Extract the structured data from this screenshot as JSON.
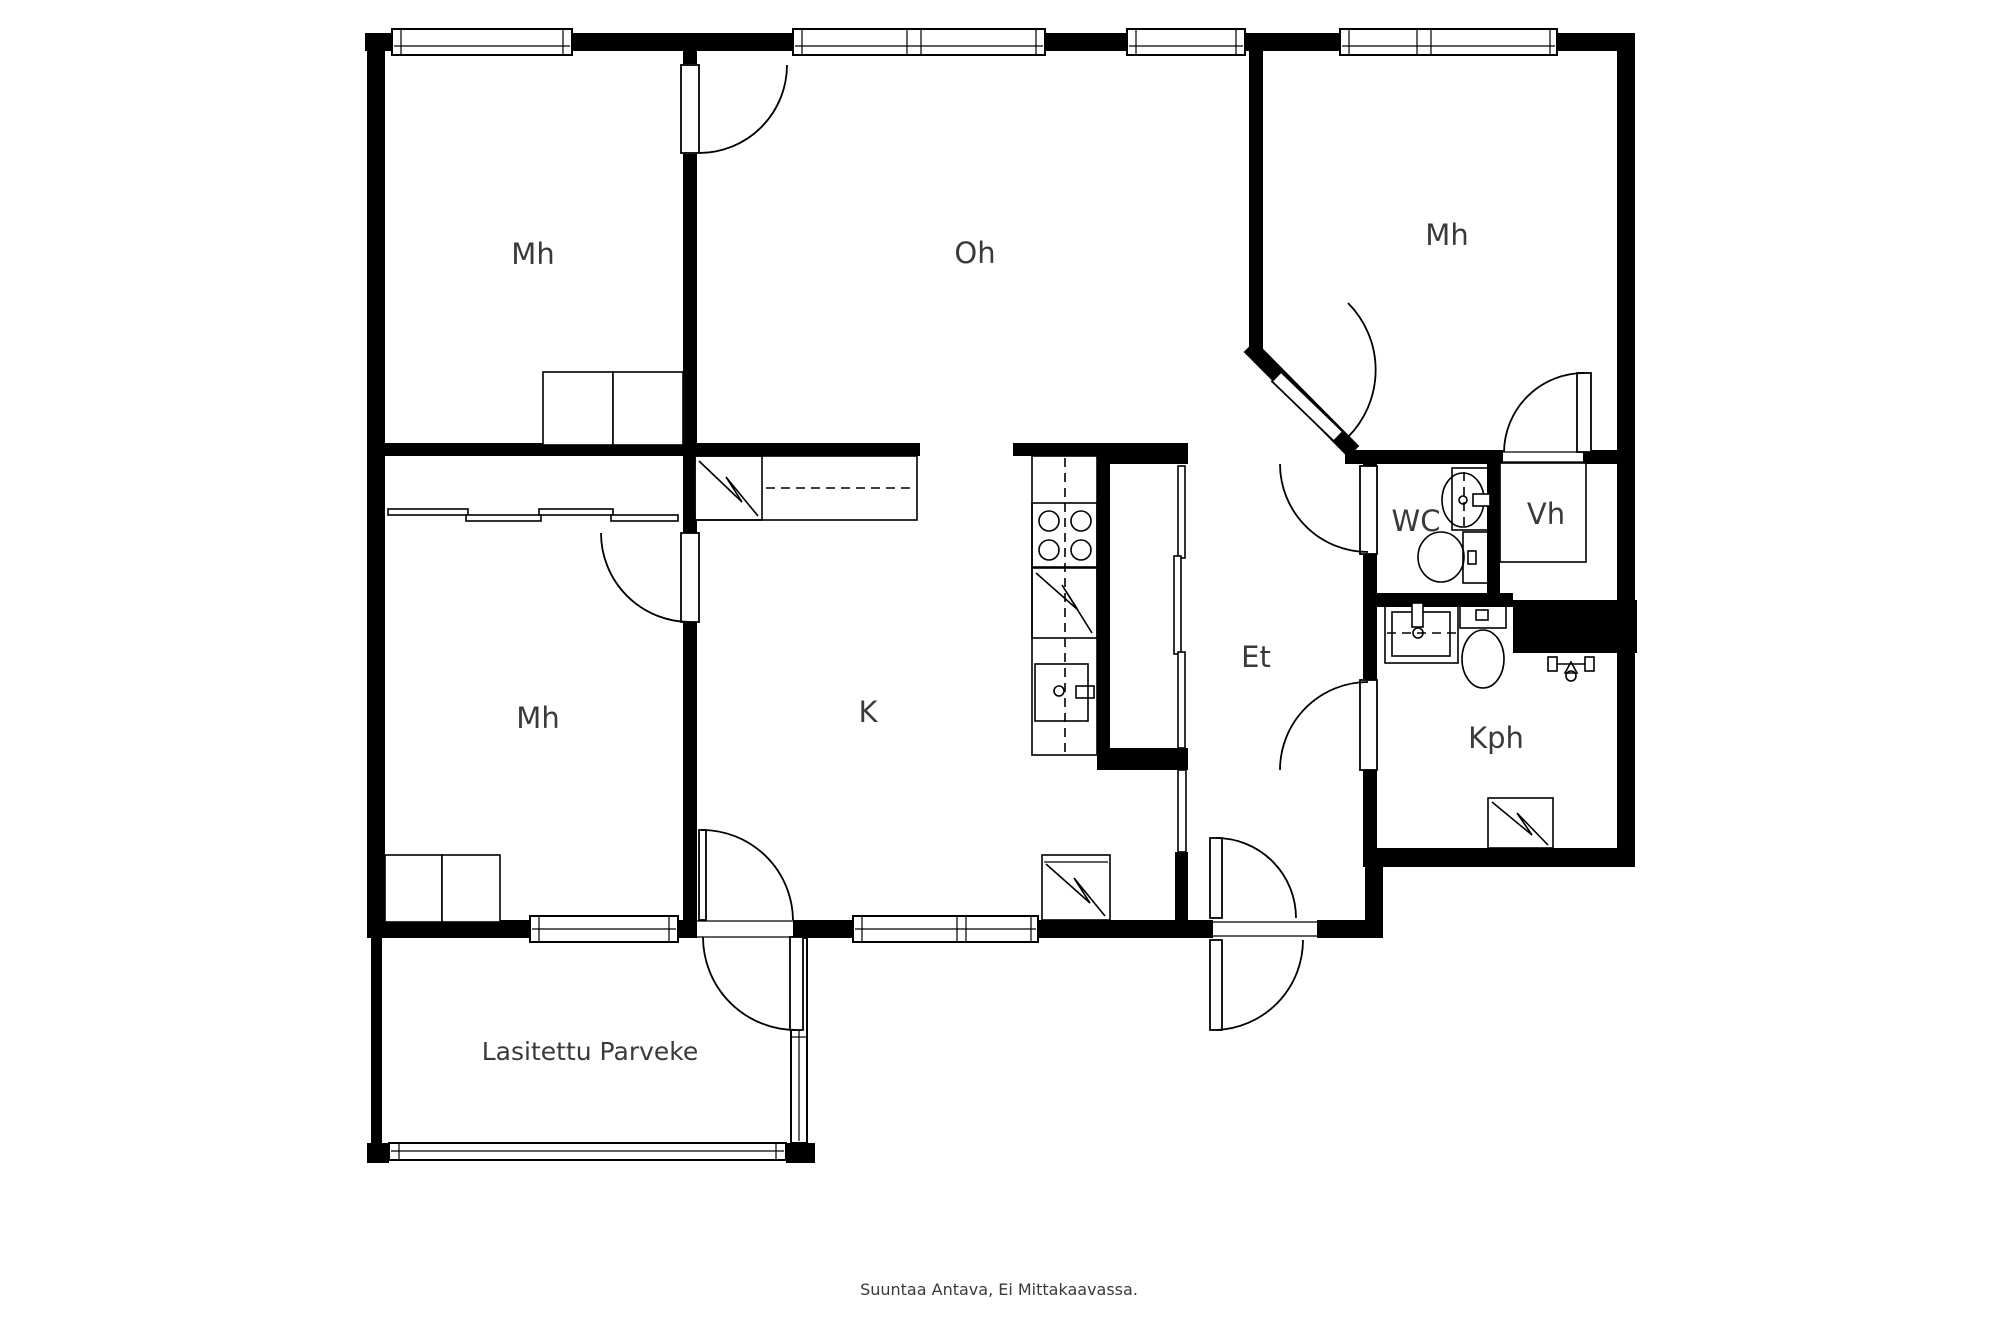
{
  "colors": {
    "background": "#ffffff",
    "walls": "#000000",
    "text": "#3a3a3a"
  },
  "rooms": [
    {
      "key": "bedroom-top-left",
      "label": "Mh"
    },
    {
      "key": "living-room",
      "label": "Oh"
    },
    {
      "key": "bedroom-top-right",
      "label": "Mh"
    },
    {
      "key": "bedroom-mid-left",
      "label": "Mh"
    },
    {
      "key": "kitchen",
      "label": "K"
    },
    {
      "key": "entry-hall",
      "label": "Et"
    },
    {
      "key": "toilet",
      "label": "WC"
    },
    {
      "key": "walk-in-closet",
      "label": "Vh"
    },
    {
      "key": "bathroom",
      "label": "Kph"
    },
    {
      "key": "glazed-balcony",
      "label": "Lasitettu Parveke"
    }
  ],
  "footer": {
    "disclaimer": "Suuntaa Antava, Ei Mittakaavassa."
  }
}
